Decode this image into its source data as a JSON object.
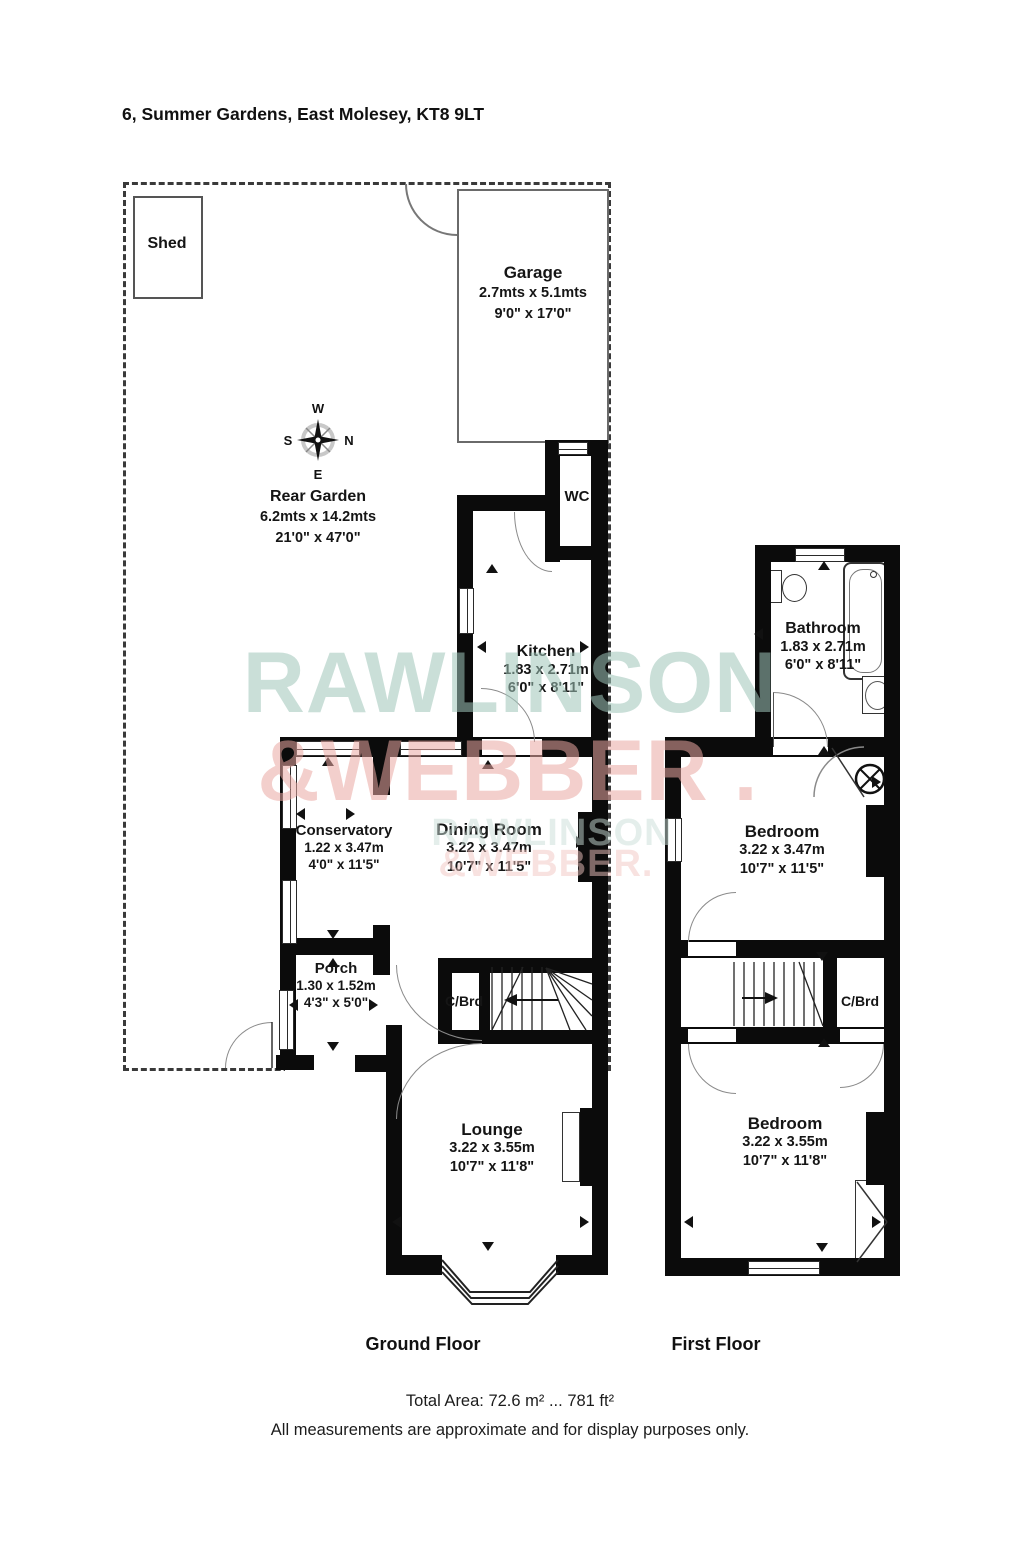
{
  "title": "6, Summer Gardens, East Molesey, KT8 9LT",
  "compass": {
    "north": "N",
    "south": "S",
    "east": "E",
    "west": "W"
  },
  "watermark": {
    "large_line1": "RAWLINSON",
    "large_line2": "&WEBBER .",
    "small_line1": "RAWLINSON",
    "small_line2": "&WEBBER.",
    "teal_large": "#9fc6ba",
    "pink_large": "#eba8a3",
    "teal_small": "#cadfd8",
    "pink_small": "#f3c6c2"
  },
  "icons": {
    "freezer": "✱✱"
  },
  "rooms": {
    "shed": {
      "name": "Shed"
    },
    "garage": {
      "name": "Garage",
      "metric": "2.7mts x 5.1mts",
      "imperial": "9'0\" x 17'0\""
    },
    "rear_garden": {
      "name": "Rear Garden",
      "metric": "6.2mts x 14.2mts",
      "imperial": "21'0\" x 47'0\""
    },
    "wc": {
      "name": "WC"
    },
    "kitchen": {
      "name": "Kitchen",
      "metric": "1.83 x 2.71m",
      "imperial": "6'0\" x 8'11\""
    },
    "conservatory": {
      "name": "Conservatory",
      "metric": "1.22 x 3.47m",
      "imperial": "4'0\" x 11'5\""
    },
    "dining_room": {
      "name": "Dining Room",
      "metric": "3.22 x 3.47m",
      "imperial": "10'7\" x 11'5\""
    },
    "porch": {
      "name": "Porch",
      "metric": "1.30 x 1.52m",
      "imperial": "4'3\" x 5'0\""
    },
    "cupboard_ground": {
      "name": "C/Brd"
    },
    "lounge": {
      "name": "Lounge",
      "metric": "3.22 x 3.55m",
      "imperial": "10'7\" x 11'8\""
    },
    "bathroom": {
      "name": "Bathroom",
      "metric": "1.83 x 2.71m",
      "imperial": "6'0\" x 8'11\""
    },
    "bedroom_one": {
      "name": "Bedroom",
      "metric": "3.22 x 3.47m",
      "imperial": "10'7\" x 11'5\""
    },
    "cupboard_first": {
      "name": "C/Brd"
    },
    "bedroom_two": {
      "name": "Bedroom",
      "metric": "3.22 x 3.55m",
      "imperial": "10'7\" x 11'8\""
    }
  },
  "floor_labels": {
    "ground": "Ground Floor",
    "first": "First Floor"
  },
  "footer": {
    "total_area": "Total Area: 72.6 m² ... 781 ft²",
    "disclaimer": "All measurements are approximate and for display purposes only."
  }
}
